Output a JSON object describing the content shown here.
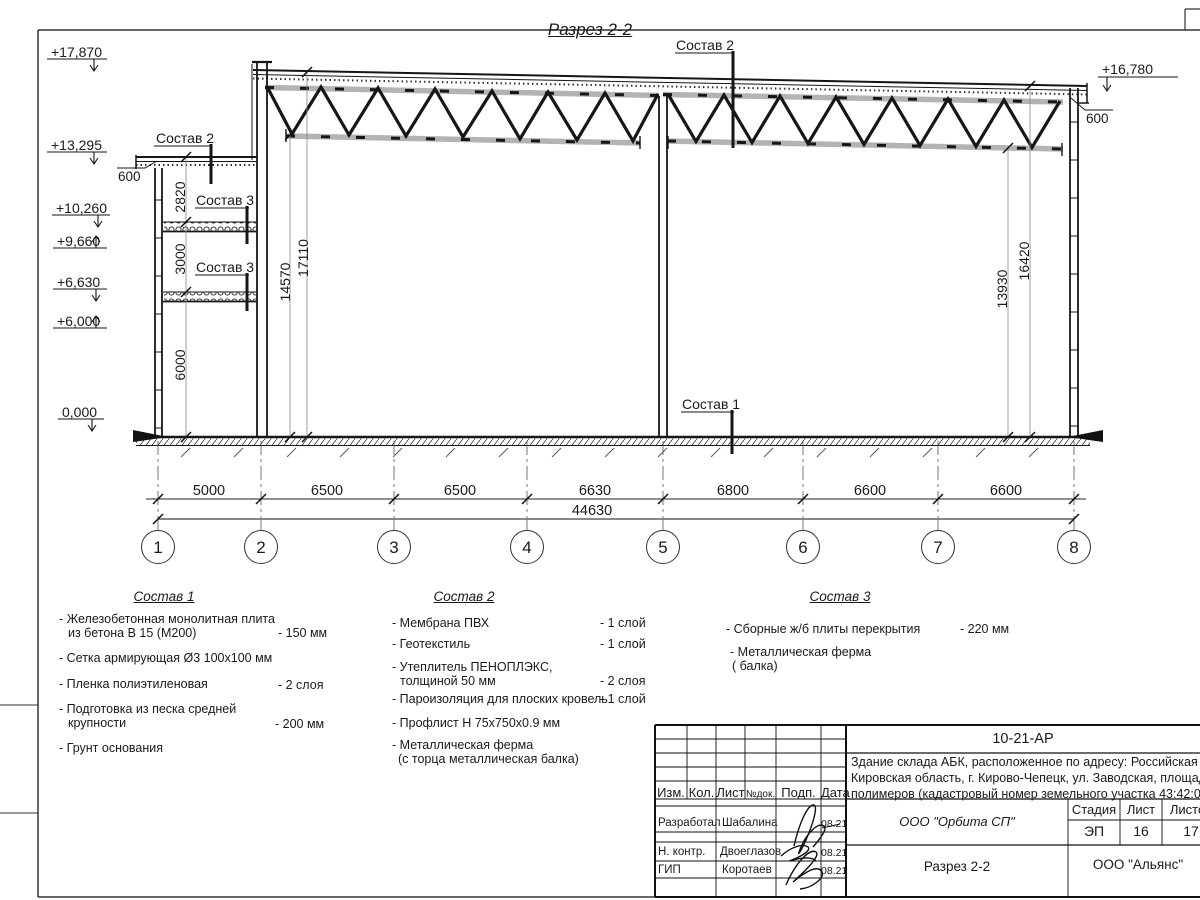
{
  "sheet": {
    "title": "Разрез 2-2"
  },
  "callouts": {
    "sostav1": "Состав 1",
    "sostav2": "Состав 2",
    "sostav3": "Состав 3",
    "dim600": "600"
  },
  "elevations": {
    "left": [
      "+17,870",
      "+13,295",
      "+10,260",
      "+9,660",
      "+6,630",
      "+6,000",
      "0,000"
    ],
    "right": "+16,780"
  },
  "vdims": {
    "annex": [
      "2820",
      "3000",
      "6000"
    ],
    "left": [
      "14570",
      "17110"
    ],
    "right": [
      "13930",
      "16420"
    ]
  },
  "hdims": {
    "segments": [
      "5000",
      "6500",
      "6500",
      "6630",
      "6800",
      "6600",
      "6600"
    ],
    "total": "44630"
  },
  "grid": {
    "labels": [
      "1",
      "2",
      "3",
      "4",
      "5",
      "6",
      "7",
      "8"
    ]
  },
  "legend1": {
    "heading": "Состав 1",
    "r0l1": "- Железобетонная  монолитная плита",
    "r0l2": "из бетона В 15 (М200)",
    "r0v": "- 150 мм",
    "r1l1": "- Сетка армирующая Ø3 100x100 мм",
    "r2l1": "- Пленка полиэтиленовая",
    "r2v": "-  2 слоя",
    "r3l1": "- Подготовка из песка средней",
    "r3l2": "крупности",
    "r3v": "- 200 мм",
    "r4l1": "- Грунт основания"
  },
  "legend2": {
    "heading": "Состав 2",
    "r0l1": "- Мембрана ПВХ",
    "r0v": "- 1 слой",
    "r1l1": "- Геотекстиль",
    "r1v": "- 1 слой",
    "r2l1": "- Утеплитель ПЕНОПЛЭКС,",
    "r2l2": "толщиной 50 мм",
    "r2v": "- 2 слоя",
    "r3l1": "- Пароизоляция для плоских кровель",
    "r3v": "- 1 слой",
    "r4l1": "- Профлист Н 75х750х0.9 мм",
    "r5l1": "- Металлическая ферма",
    "r5l2": "(с торца металлическая балка)"
  },
  "legend3": {
    "heading": "Состав 3",
    "r0l1": "- Сборные ж/б плиты перекрытия",
    "r0v": "- 220 мм",
    "r1l1": "- Металлическая ферма",
    "r1l2": "( балка)"
  },
  "titleblock": {
    "doc_number": "10-21-АР",
    "desc_line1": "Здание склада АБК, расположенное по адресу: Российская Федерация,",
    "desc_line2": "Кировская область, г. Кирово-Чепецк, ул. Заводская, площадка завода",
    "desc_line3": "полимеров (кадастровый номер земельного участка 43:42:000022:3",
    "col_izm": "Изм.",
    "col_kol": "Кол.",
    "col_list": "Лист",
    "col_ndoc": "№док.",
    "col_podp": "Подп.",
    "col_data": "Дата",
    "row1_role": "Разработал",
    "row1_name": "Шабалина",
    "row1_date": "08.21",
    "row2_role": "Н. контр.",
    "row2_name": "Двоеглазов",
    "row2_date": "08.21",
    "row3_role": "ГИП",
    "row3_name": "Коротаев",
    "row3_date": "08.21",
    "org": "ООО \"Орбита СП\"",
    "stage_label": "Стадия",
    "sheet_label": "Лист",
    "sheets_label": "Листов",
    "stage_value": "ЭП",
    "sheet_value": "16",
    "sheets_value": "17",
    "doc_title": "Разрез 2-2",
    "company": "ООО \"Альянс\""
  }
}
